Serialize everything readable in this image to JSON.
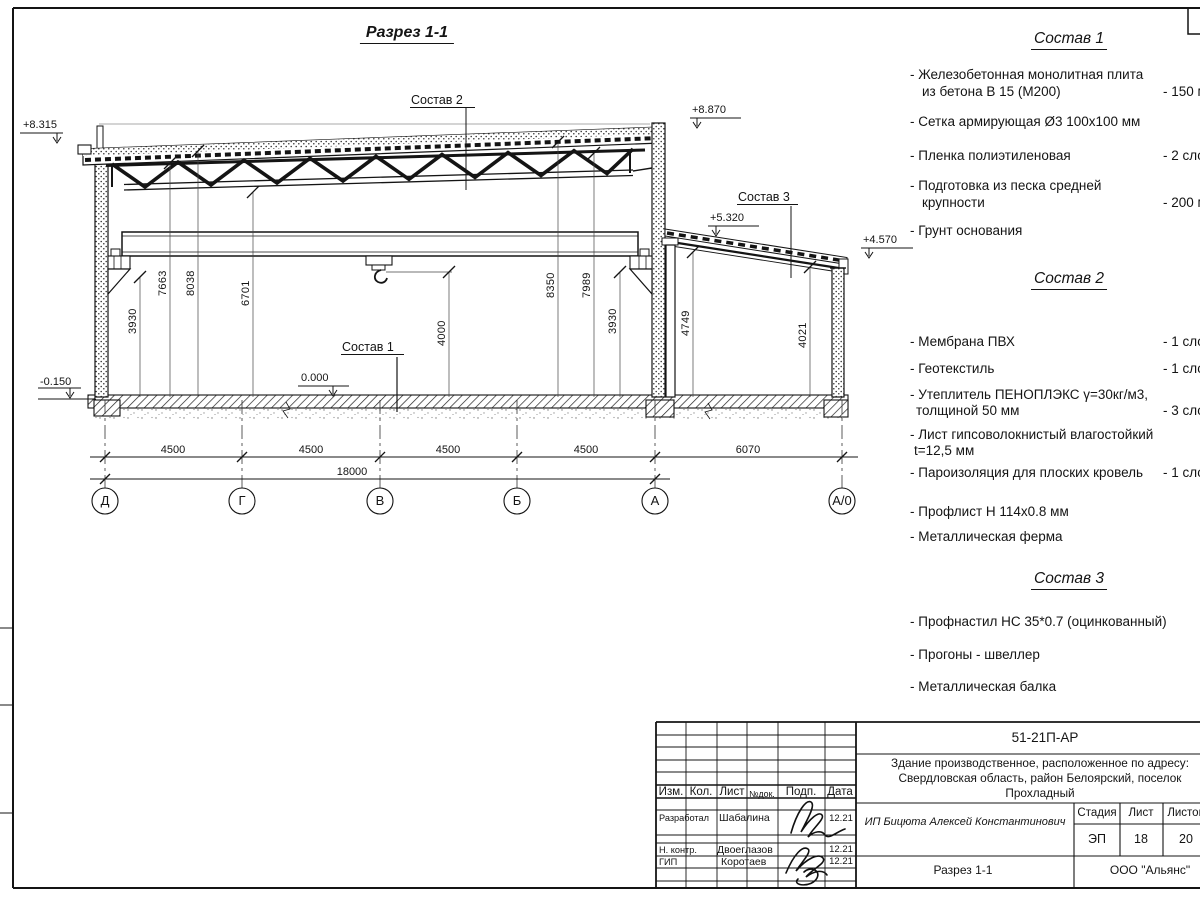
{
  "drawing": {
    "title": "Разрез 1-1",
    "callouts": {
      "c1": "Состав 1",
      "c2": "Состав 2",
      "c3": "Состав 3"
    },
    "elevations": {
      "roof_left": "+8.315",
      "parapet_right": "+8.870",
      "annex_left": "+5.320",
      "annex_right": "+4.570",
      "floor": "0.000",
      "ground": "-0.150"
    },
    "vdims": [
      "3930",
      "7663",
      "8038",
      "6701",
      "4000",
      "8350",
      "7989",
      "3930",
      "4749",
      "4021"
    ],
    "hdims": [
      "4500",
      "4500",
      "4500",
      "4500",
      "6070"
    ],
    "total_dim": "18000",
    "axes": [
      "Д",
      "Г",
      "В",
      "Б",
      "А",
      "А/0"
    ]
  },
  "specs": {
    "s1": {
      "title": "Состав 1",
      "i1l1": "- Железобетонная  монолитная плита",
      "i1l2": "из бетона В 15 (М200)",
      "i1q": "- 150 м",
      "i2": "- Сетка армирующая Ø3 100x100 мм",
      "i3": "- Пленка полиэтиленовая",
      "i3q": "-  2 сло",
      "i4l1": "- Подготовка из песка средней",
      "i4l2": "крупности",
      "i4q": "- 200 м",
      "i5": "- Грунт основания"
    },
    "s2": {
      "title": "Состав 2",
      "i1": "- Мембрана ПВХ",
      "i1q": "- 1 сло",
      "i2": "- Геотекстиль",
      "i2q": "- 1 сло",
      "i3l1": "- Утеплитель ПЕНОПЛЭКС γ=30кг/м3,",
      "i3l2": "толщиной 50 мм",
      "i3q": "- 3 сло",
      "i4l1": "- Лист гипсоволокнистый влагостойкий",
      "i4l2": "t=12,5 мм",
      "i5": "- Пароизоляция для плоских кровель",
      "i5q": "- 1 сло",
      "i6": "- Профлист Н 114x0.8 мм",
      "i7": "- Металлическая ферма"
    },
    "s3": {
      "title": "Состав 3",
      "i1": "- Профнастил НС 35*0.7 (оцинкованный)",
      "i2": "- Прогоны - швеллер",
      "i3": "- Металлическая балка"
    }
  },
  "titleblock": {
    "doc_number": "51-21П-АР",
    "object1": "Здание производственное, расположенное по адресу:",
    "object2": "Свердловская область, район Белоярский, поселок",
    "object3": "Прохладный",
    "company": "ИП Бицюта Алексей Константинович",
    "stage_label": "Стадия",
    "sheet_label": "Лист",
    "sheets_label": "Листов",
    "stage": "ЭП",
    "sheet": "18",
    "sheets": "20",
    "view_name": "Разрез 1-1",
    "org": "ООО \"Альянс\"",
    "cols": {
      "izm": "Изм.",
      "kol": "Кол.",
      "list": "Лист",
      "doc": "№док.",
      "podp": "Подп.",
      "data": "Дата"
    },
    "r1_role": "Разработал",
    "r1_name": "Шабалина",
    "r1_date": "12.21",
    "r2_role": "Н. контр.",
    "r2_name": "Двоеглазов",
    "r2_date": "12.21",
    "r3_role": "ГИП",
    "r3_name": "Коротаев",
    "r3_date": "12.21"
  }
}
